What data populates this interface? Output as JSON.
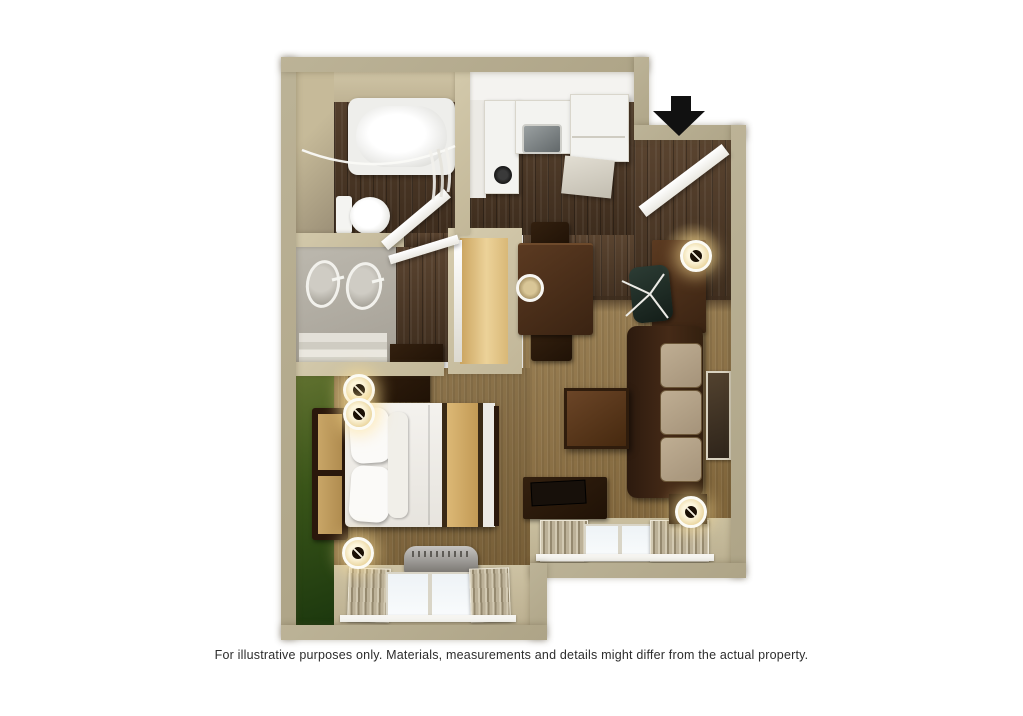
{
  "disclaimer": {
    "text": "For illustrative purposes only.  Materials, measurements and details might differ from the actual property."
  },
  "entry": {
    "arrow_icon": "black-down-arrow",
    "door": "entry-door-open-inward"
  },
  "floor_plan": {
    "type": "3d-top-down-studio-suite",
    "rooms": [
      {
        "name": "bathroom",
        "fixtures": [
          "bathtub",
          "shower-curtain",
          "toilet",
          "swing-door"
        ]
      },
      {
        "name": "vanity-area",
        "fixtures": [
          "double-sink-vanity",
          "towel-shelves",
          "swing-door"
        ]
      },
      {
        "name": "closet",
        "fixtures": [
          "wardrobe-interior",
          "closet-door"
        ]
      },
      {
        "name": "kitchen",
        "fixtures": [
          "counter",
          "sink",
          "cooktop-burner",
          "refrigerator",
          "lower-cabinet"
        ]
      },
      {
        "name": "dining-area",
        "fixtures": [
          "dining-table",
          "chair",
          "chair",
          "place-setting"
        ]
      },
      {
        "name": "work-area",
        "fixtures": [
          "desk",
          "office-chair",
          "desk-lamp"
        ]
      },
      {
        "name": "living-area",
        "fixtures": [
          "sofa",
          "coffee-table",
          "tv-console",
          "tv",
          "wall-art",
          "end-table",
          "table-lamp",
          "window-with-curtains"
        ]
      },
      {
        "name": "sleeping-area",
        "fixtures": [
          "bed",
          "headboard",
          "pillows",
          "bed-runner",
          "nightstand",
          "table-lamp",
          "table-lamp",
          "floor-lamp",
          "dresser",
          "ac-unit",
          "window-with-curtains",
          "green-accent-wall"
        ]
      }
    ]
  },
  "colors": {
    "wall_outer": "#b1a88b",
    "wall_inner": "#cdc2a4",
    "hardwood": "#4a3525",
    "carpet_living": "#91784f",
    "carpet_bedroom": "#83683f",
    "accent_wall_green": "#2e4a18",
    "kitchen_white": "#f2f1ed",
    "sofa_leather": "#33200f",
    "sofa_cushion": "#b5a389",
    "bedding_white": "#f0eee9",
    "bed_runner_tan": "#d2ae6b",
    "window_glass": "#f2f6f8",
    "entry_arrow": "#111111"
  }
}
